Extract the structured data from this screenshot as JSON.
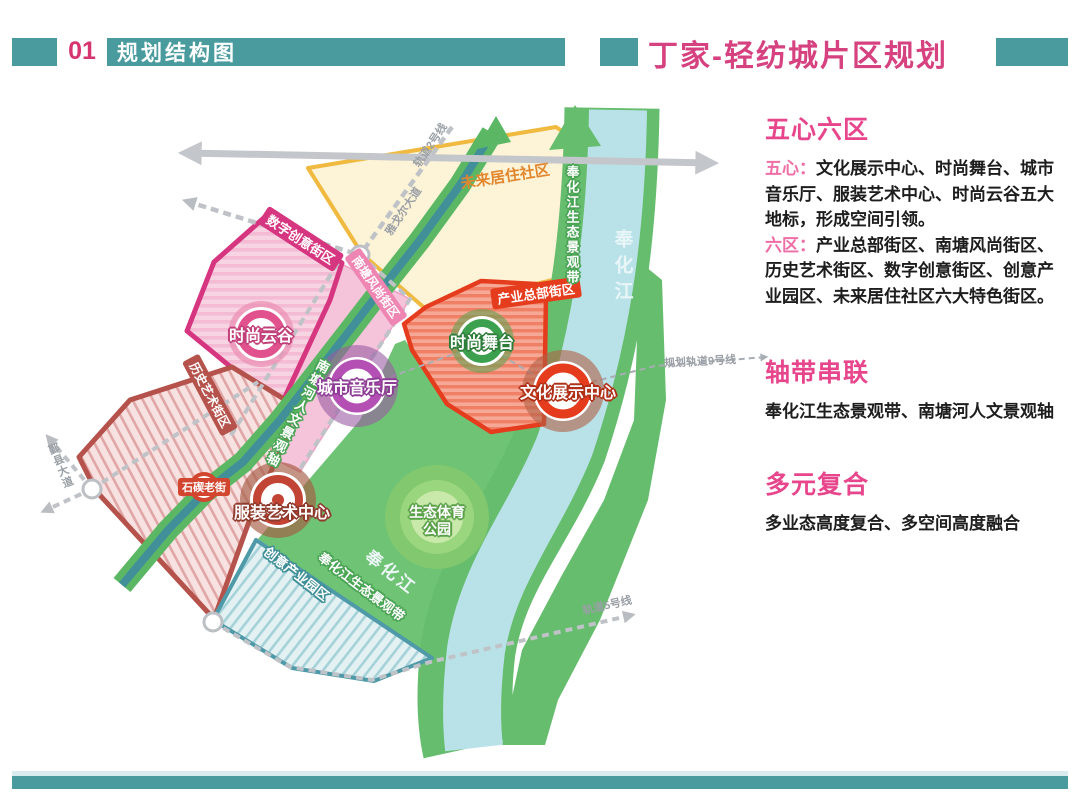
{
  "header": {
    "index": "01",
    "section_title": "规划结构图",
    "page_title": "丁家-轻纺城片区规划"
  },
  "panel": {
    "five_hearts": {
      "title": "五心六区",
      "lead1": "五心：",
      "text1": "文化展示中心、时尚舞台、城市音乐厅、服装艺术中心、时尚云谷五大地标，形成空间引领。",
      "lead2": "六区：",
      "text2": "产业总部街区、南塘风尚街区、历史艺术街区、数字创意街区、创意产业园区、未来居住社区六大特色街区。"
    },
    "axes": {
      "title": "轴带串联",
      "text": "奉化江生态景观带、南塘河人文景观轴"
    },
    "mixed": {
      "title": "多元复合",
      "text": "多业态高度复合、多空间高度融合"
    }
  },
  "map": {
    "zone_labels": {
      "future_residential": "未来居住社区",
      "digital_creative": "数字创意街区",
      "nantang_fashion": "南塘风尚街区",
      "industry_hq": "产业总部街区",
      "history_art": "历史艺术街区",
      "creative_park": "创意产业园区"
    },
    "landmarks": {
      "fashion_cloud_valley": "时尚云谷",
      "city_concert_hall": "城市音乐厅",
      "fashion_stage": "时尚舞台",
      "culture_exhibition": "文化展示中心",
      "fashion_art_center": "服装艺术中心",
      "eco_park_line1": "生态体育",
      "eco_park_line2": "公园",
      "shiqi_old_street": "石碶老街"
    },
    "water": {
      "river_top": "奉化江",
      "river_bottom": "奉化江",
      "eco_belt_top": "奉化江生态景观带",
      "eco_belt_bottom": "奉化江生态景观带",
      "nantang_axis": "南塘河人文景观轴"
    },
    "roads": {
      "rail2": "轨道2号线",
      "youngor_ave": "雅戈尔大道",
      "yinxian_ave": "鄞县大道",
      "rail9": "规划轨道9号线",
      "rail5": "轨道5号线"
    }
  },
  "colors": {
    "teal_band": "#4a9b9e",
    "title_pink": "#d6417f",
    "panel_heading": "#e8468c",
    "panel_lead": "#ef6ea6",
    "yellow_zone_border": "#f0b93f",
    "magenta_zone_border": "#d6357f",
    "red_zone_border": "#e63c1e",
    "history_zone_border": "#b5524b",
    "creative_zone_border": "#4e9aa8",
    "corridor_green": "#5cb765",
    "corridor_core_teal": "#418f98",
    "river_blue": "#b9e2e8",
    "bank_green": "#66bd6e",
    "road_gray": "#c3c6ca"
  }
}
